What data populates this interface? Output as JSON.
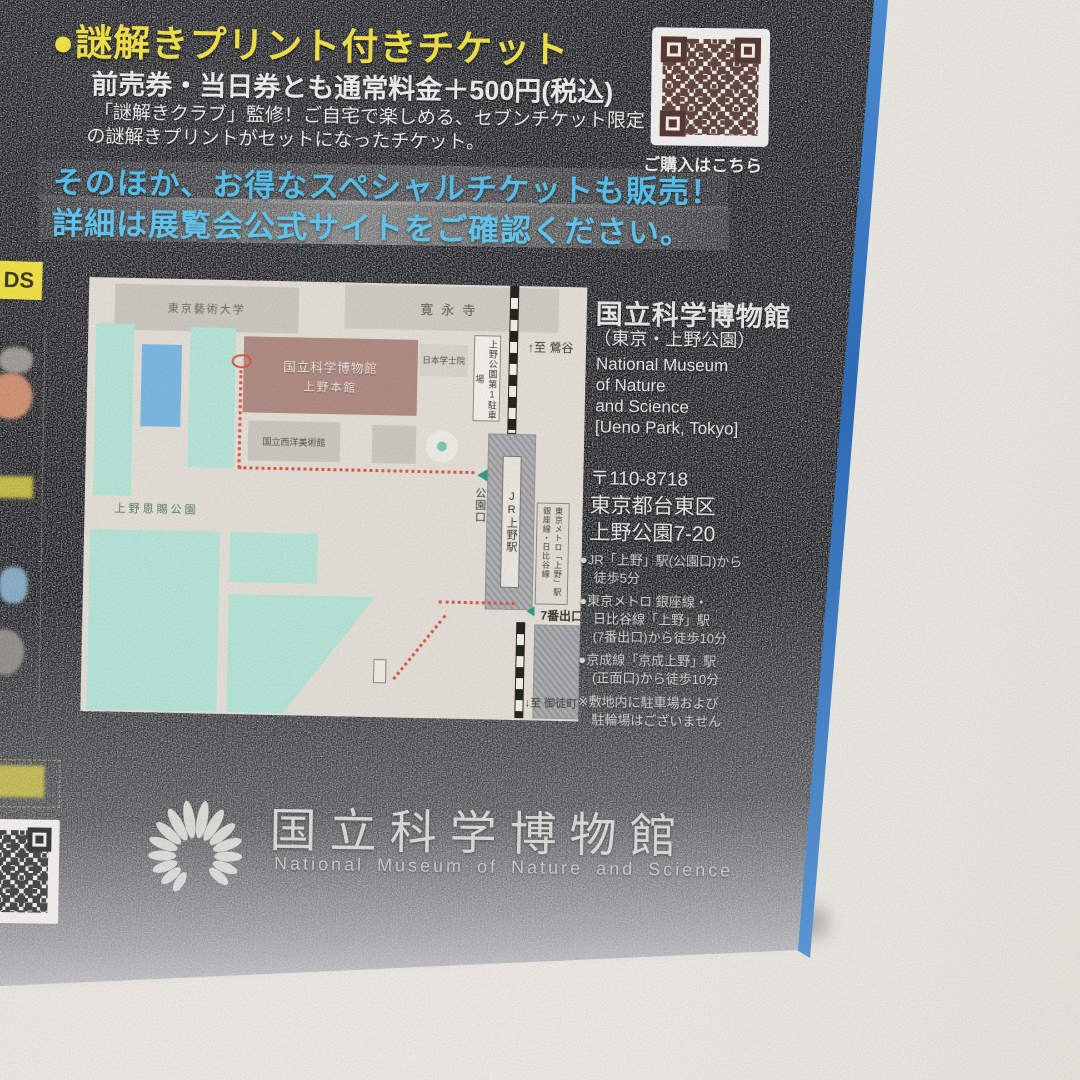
{
  "photo": {
    "background_color": "#EBE9E2"
  },
  "flyer": {
    "edge_color": "#3B7FD0",
    "ticket": {
      "heading": "●謎解きプリント付きチケット",
      "price_line": "前売券・当日券とも通常料金＋500円(税込)",
      "desc_line1": "「謎解きクラブ」監修！ご自宅で楽しめる、セブンチケット限定",
      "desc_line2": "の謎解きプリントがセットになったチケット。"
    },
    "purchase_qr": {
      "caption": "ご購入はこちら",
      "module_color": "#583A33"
    },
    "promo": {
      "line1": "そのほか、お得なスペシャルチケットも販売！",
      "line2": "詳細は展覧会公式サイトをご確認ください。",
      "text_color": "#5CC3EF"
    },
    "map": {
      "labels": {
        "art_univ": "東京藝術大学",
        "kaneiji": "寛永寺",
        "museum_line1": "国立科学博物館",
        "museum_line2": "上野本館",
        "gakushiin": "日本学士院",
        "seiyo_museum": "国立西洋美術館",
        "park": "上野恩賜公園",
        "parking": "上野公園第1駐車場",
        "to_uguisudani": "↑至 鶯谷",
        "jr_station": "JR上野駅",
        "park_exit": "公園口",
        "metro_line1": "東京メトロ「上野」駅",
        "metro_line2": "銀座線・日比谷線",
        "exit7": "7番出口",
        "to_okachimachi": "↓至 御徒町"
      },
      "colors": {
        "teal": "#B7E5D7",
        "pond": "#7DB9E3",
        "museum": "#B08D85",
        "route": "#E0584A"
      }
    },
    "venue": {
      "name_jp": "国立科学博物館",
      "name_sub": "（東京・上野公園）",
      "name_en_line1": "National Museum",
      "name_en_line2": "of Nature",
      "name_en_line3": "and Science",
      "name_en_line4": "[Ueno Park, Tokyo]",
      "postal": "〒110-8718",
      "address_line1": "東京都台東区",
      "address_line2": "上野公園7-20",
      "access": [
        [
          "●JR「上野」駅(公園口)から",
          "徒歩5分"
        ],
        [
          "●東京メトロ 銀座線・",
          "日比谷線「上野」駅",
          "(7番出口)から徒歩10分"
        ],
        [
          "●京成線「京成上野」駅",
          "(正面口)から徒歩10分"
        ]
      ],
      "note_line1": "※敷地内に駐車場および",
      "note_line2": "駐輪場はございません"
    },
    "logo": {
      "name_jp": "国立科学博物館",
      "name_en": "National Museum of Nature and Science"
    },
    "fragments": {
      "goods_tab": "DS"
    }
  }
}
